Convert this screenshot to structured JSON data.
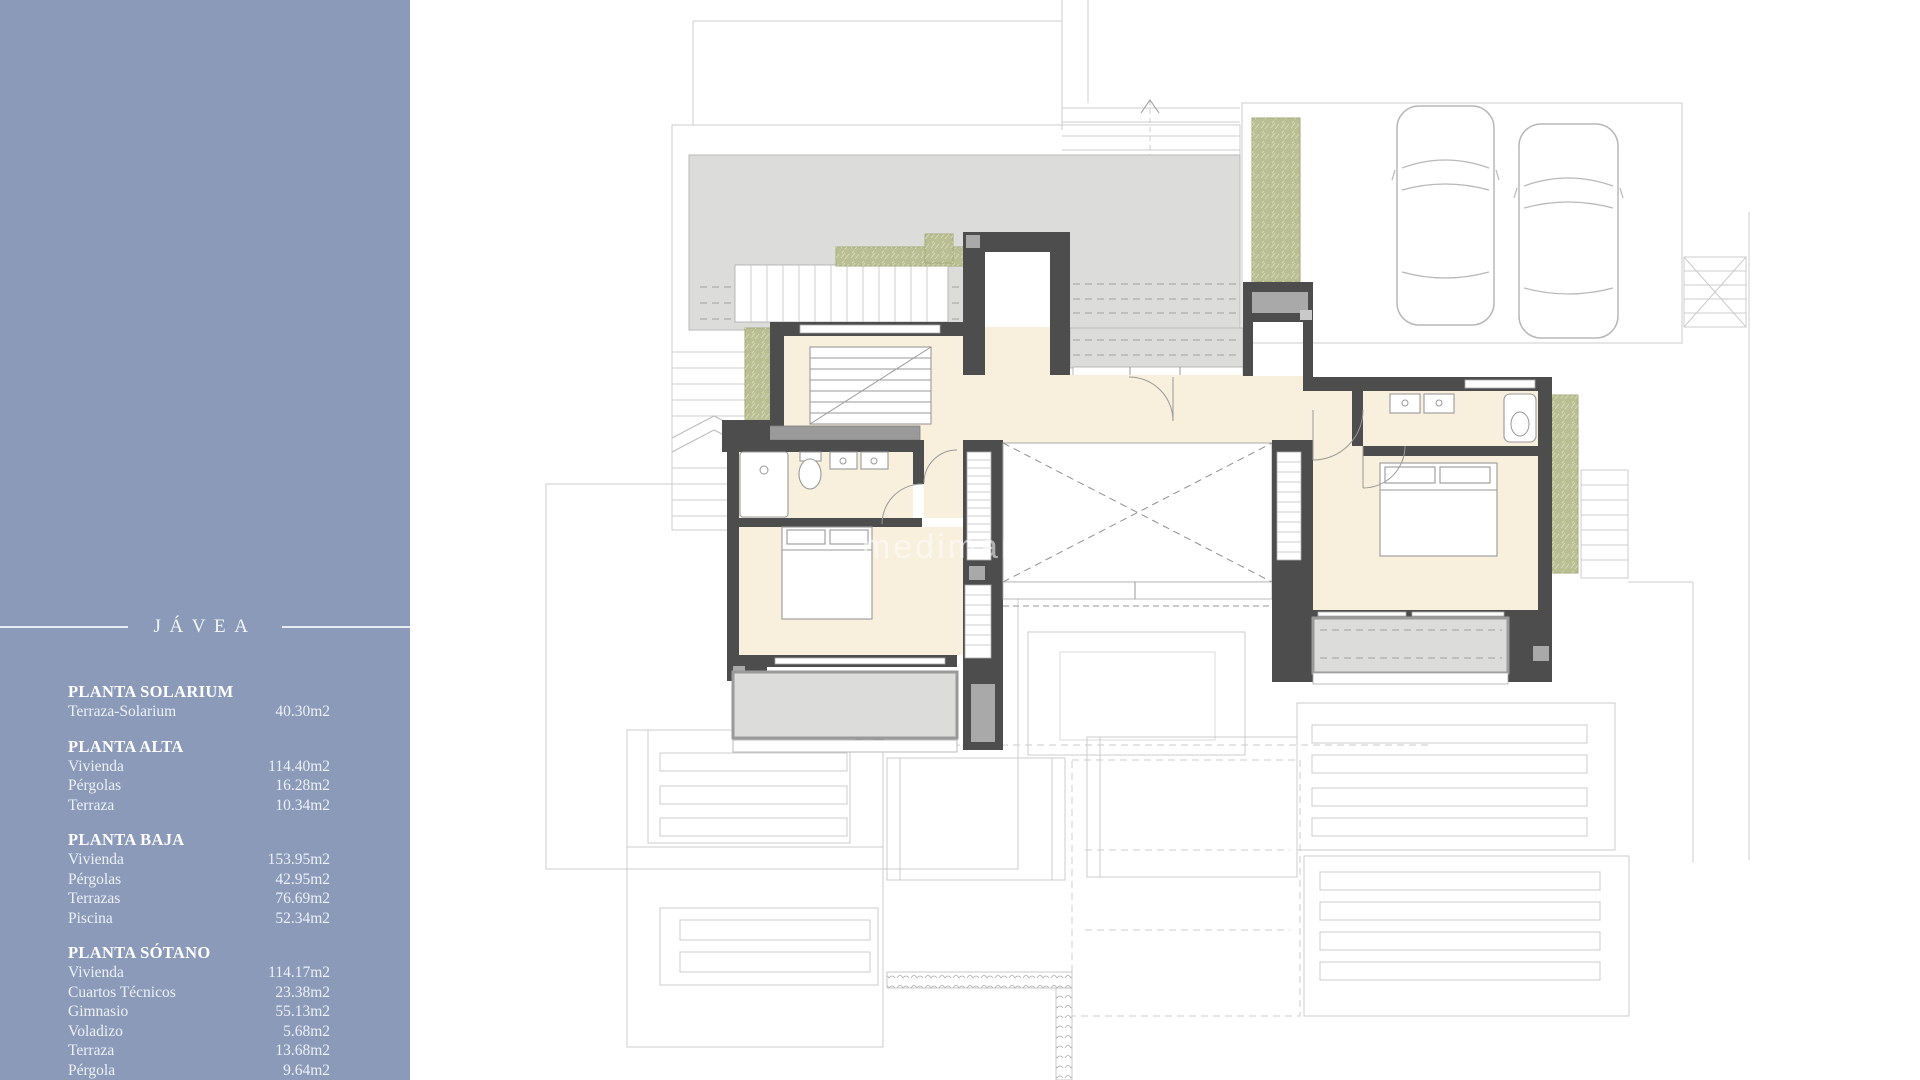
{
  "sidebar": {
    "title": "JÁVEA",
    "sections": [
      {
        "heading": "PLANTA SOLARIUM",
        "items": [
          {
            "label": "Terraza-Solarium",
            "value": "40.30m2"
          }
        ]
      },
      {
        "heading": "PLANTA ALTA",
        "items": [
          {
            "label": "Vivienda",
            "value": "114.40m2"
          },
          {
            "label": "Pérgolas",
            "value": "16.28m2"
          },
          {
            "label": "Terraza",
            "value": "10.34m2"
          }
        ]
      },
      {
        "heading": "PLANTA BAJA",
        "items": [
          {
            "label": "Vivienda",
            "value": "153.95m2"
          },
          {
            "label": "Pérgolas",
            "value": "42.95m2"
          },
          {
            "label": "Terrazas",
            "value": "76.69m2"
          },
          {
            "label": "Piscina",
            "value": "52.34m2"
          }
        ]
      },
      {
        "heading": "PLANTA SÓTANO",
        "items": [
          {
            "label": "Vivienda",
            "value": "114.17m2"
          },
          {
            "label": "Cuartos Técnicos",
            "value": "23.38m2"
          },
          {
            "label": "Gimnasio",
            "value": "55.13m2"
          },
          {
            "label": "Voladizo",
            "value": "5.68m2"
          },
          {
            "label": "Terraza",
            "value": "13.68m2"
          },
          {
            "label": "Pérgola",
            "value": "9.64m2"
          }
        ]
      }
    ]
  },
  "plan": {
    "watermark": "medimare",
    "watermark_suffix": "ne"
  },
  "theme": {
    "sidebar": "#8b9ab9",
    "sline": "#e7ecf4",
    "stext": "#f3f6fa",
    "wall": "#4d4d4d",
    "ledge": "#9a9a9a",
    "terrace": "#dcdddb",
    "room": "#f8efdc",
    "green": "#b9bf92",
    "faint": "#cccccc",
    "car": "#b8b8b8",
    "wm": "#ffffff"
  }
}
